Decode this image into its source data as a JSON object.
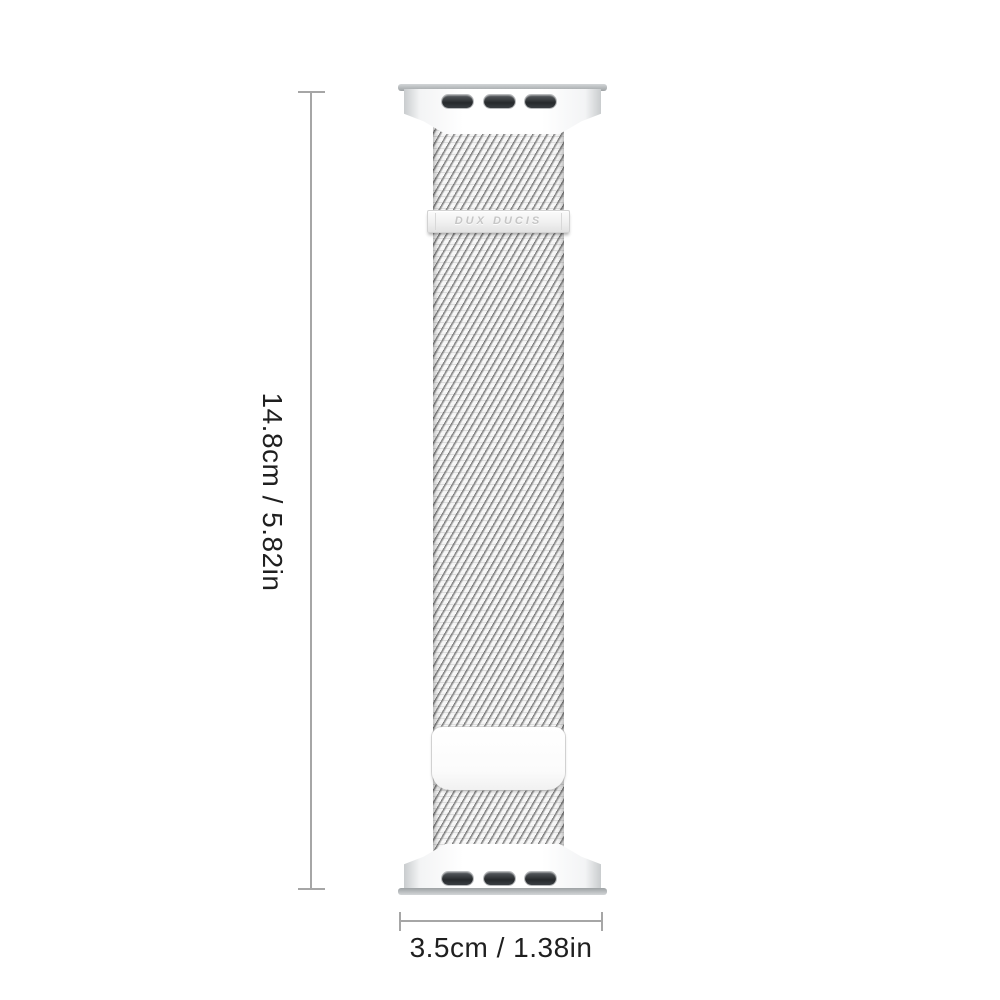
{
  "dimensions": {
    "height": {
      "label": "14.8cm / 5.82in",
      "cm": "14.8",
      "in": "5.82"
    },
    "width": {
      "label": "3.5cm / 1.38in",
      "cm": "3.5",
      "in": "1.38"
    }
  },
  "product": {
    "brand_engraving": "DUX DUCIS"
  },
  "colors": {
    "background": "#ffffff",
    "dimension_line": "#a6a6a6",
    "dimension_text": "#1f1f1f",
    "mesh_base": "#f5f5f5",
    "mesh_wire": "#7c7c7c",
    "lug_bar": "#b5b9bb",
    "connector_slot": "#2d3135",
    "brand_engraving_text": "#c6c6c6",
    "clasp_plate": "#ffffff"
  }
}
